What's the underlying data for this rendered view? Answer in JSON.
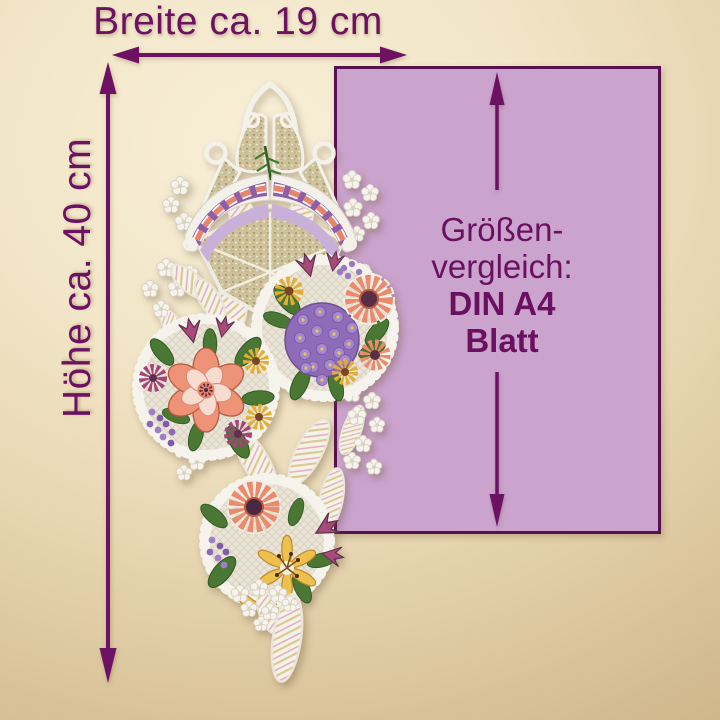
{
  "dimensions": {
    "width_label": "Breite ca. 19 cm",
    "height_label": "Höhe ca. 40 cm"
  },
  "comparison": {
    "line1": "Größen-",
    "line2": "vergleich:",
    "line3": "DIN A4",
    "line4": "Blatt"
  },
  "colors": {
    "background_gold_light": "#f8efd8",
    "background_gold_dark": "#c8ab7d",
    "dimension_accent_purple": "#6d1162",
    "a4_sheet_fill": "#cba4ce",
    "a4_sheet_border": "#571150",
    "lace_white": "#f5f2ea",
    "gold_mesh": "#cec29c",
    "embroidery_coral": "#ec8a6e",
    "embroidery_purple": "#9d7cc5",
    "embroidery_magenta": "#a34677",
    "embroidery_yellow": "#e2ae33",
    "embroidery_green": "#4a7733"
  }
}
